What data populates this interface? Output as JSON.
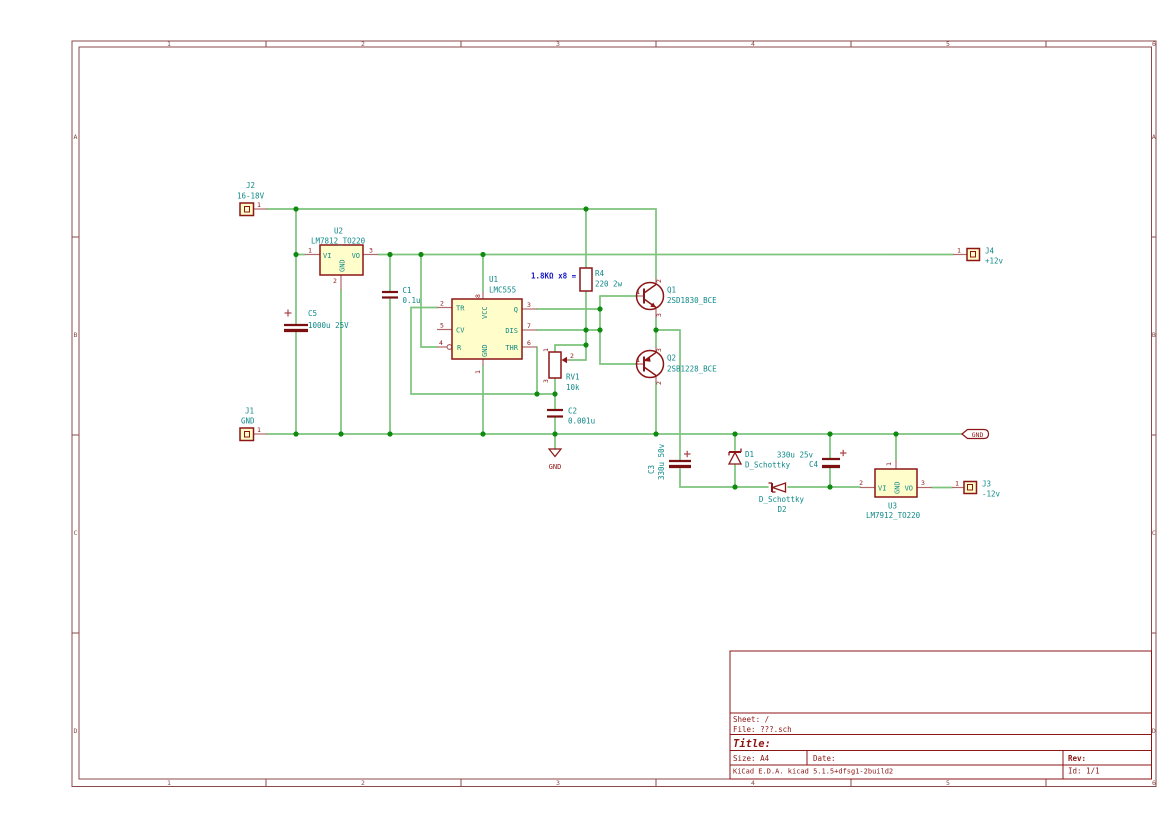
{
  "colors": {
    "wire_green": "#7cc47c",
    "junction_green": "#118a11",
    "symbol_outline_red": "#8c1616",
    "symbol_fill_yellow": "#fffdc9",
    "pin_lead_red": "#b06868",
    "reference_value_teal": "#0f8989",
    "note_blue": "#1616c8",
    "frame_brown": "#8a4a4a",
    "background": "#ffffff"
  },
  "frame": {
    "columns": [
      "1",
      "2",
      "3",
      "4",
      "5",
      "6"
    ],
    "rows": [
      "A",
      "B",
      "C",
      "D"
    ]
  },
  "title_block": {
    "sheet": "Sheet: /",
    "file": "File: ???.sch",
    "title_label": "Title:",
    "size": "Size: A4",
    "date": "Date:",
    "rev": "Rev:",
    "company": "KiCad E.D.A.  kicad 5.1.5+dfsg1-2build2",
    "id": "Id: 1/1"
  },
  "annotations": {
    "note1": "1.8KΩ x8 ="
  },
  "power": {
    "gnd_flag": "GND",
    "gnd_symbol": "GND"
  },
  "components": {
    "J1": {
      "ref": "J1",
      "value": "GND",
      "pin1": "1"
    },
    "J2": {
      "ref": "J2",
      "value": "16-18V",
      "pin1": "1"
    },
    "J3": {
      "ref": "J3",
      "value": "-12v",
      "pin1": "1"
    },
    "J4": {
      "ref": "J4",
      "value": "+12v",
      "pin1": "1"
    },
    "U1": {
      "ref": "U1",
      "value": "LMC555",
      "pin_names": {
        "tr": "TR",
        "cv": "CV",
        "r": "R",
        "vcc": "VCC",
        "gnd": "GND",
        "q": "Q",
        "dis": "DIS",
        "thr": "THR"
      },
      "pin_nums": {
        "tr": "2",
        "cv": "5",
        "r": "4",
        "vcc": "8",
        "gnd": "1",
        "q": "3",
        "dis": "7",
        "thr": "6"
      }
    },
    "U2": {
      "ref": "U2",
      "value": "LM7812_TO220",
      "pin_names": {
        "vi": "VI",
        "gnd": "GND",
        "vo": "VO"
      },
      "pin_nums": {
        "vi": "1",
        "gnd": "2",
        "vo": "3"
      }
    },
    "U3": {
      "ref": "U3",
      "value": "LM7912_TO220",
      "pin_names": {
        "vi": "VI",
        "gnd": "GND",
        "vo": "VO"
      },
      "pin_nums": {
        "vi": "2",
        "gnd": "1",
        "vo": "3"
      }
    },
    "Q1": {
      "ref": "Q1",
      "value": "2SD1830_BCE",
      "pin_nums": {
        "b": "1",
        "c": "2",
        "e": "3"
      }
    },
    "Q2": {
      "ref": "Q2",
      "value": "2SB1228_BCE",
      "pin_nums": {
        "b": "1",
        "c": "2",
        "e": "3"
      }
    },
    "R4": {
      "ref": "R4",
      "value": "220 2w"
    },
    "RV1": {
      "ref": "RV1",
      "value": "10k",
      "pin_nums": {
        "p1": "1",
        "p2": "2",
        "p3": "3"
      }
    },
    "C1": {
      "ref": "C1",
      "value": "0.1u"
    },
    "C2": {
      "ref": "C2",
      "value": "0.001u"
    },
    "C3": {
      "ref": "C3",
      "value": "330u 50v"
    },
    "C4": {
      "ref": "C4",
      "value": "330u 25v"
    },
    "C5": {
      "ref": "C5",
      "value": "1000u 25V"
    },
    "D1": {
      "ref": "D1",
      "value": "D_Schottky"
    },
    "D2": {
      "ref": "D2",
      "value": "D_Schottky"
    }
  }
}
